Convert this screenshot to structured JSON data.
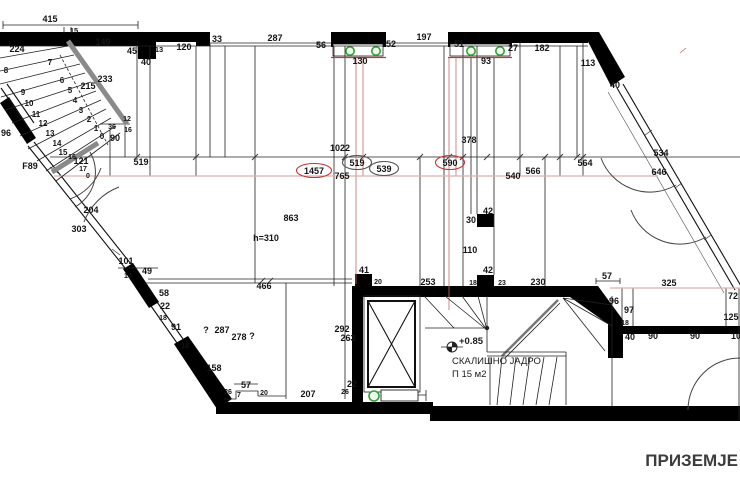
{
  "title": "ПРИЗЕМЈЕ",
  "stair_core": {
    "level": "+0.85",
    "name": "СКАЛИШНО ЈАДРО",
    "area": "П 15 м2"
  },
  "colors": {
    "wall": "#000000",
    "accent_red": "#cc3333",
    "pink_line": "#ddb0b0",
    "column_green": "#2fa32f",
    "rail_gray": "#8a8a8a",
    "title_gray": "#3c3c3c"
  },
  "icons": {
    "level_marker": "half-filled-circle-benchmark",
    "column": "green-circle",
    "elevator": "crossed-box"
  },
  "plan": {
    "labels": [
      {
        "t": "415",
        "x": 50,
        "y": 19
      },
      {
        "t": "15",
        "x": 74,
        "y": 30,
        "fs": 7.5
      },
      {
        "t": "224",
        "x": 17,
        "y": 49
      },
      {
        "t": "149",
        "x": 103,
        "y": 42
      },
      {
        "t": "45",
        "x": 132,
        "y": 51
      },
      {
        "t": "13",
        "x": 159,
        "y": 49,
        "fs": 7.5
      },
      {
        "t": "40",
        "x": 146,
        "y": 62
      },
      {
        "t": "120",
        "x": 184,
        "y": 47
      },
      {
        "t": "33",
        "x": 217,
        "y": 39
      },
      {
        "t": "287",
        "x": 275,
        "y": 38
      },
      {
        "t": "56",
        "x": 321,
        "y": 45
      },
      {
        "t": "130",
        "x": 360,
        "y": 61
      },
      {
        "t": "52",
        "x": 391,
        "y": 44
      },
      {
        "t": "197",
        "x": 424,
        "y": 37
      },
      {
        "t": "51",
        "x": 459,
        "y": 44
      },
      {
        "t": "93",
        "x": 486,
        "y": 61
      },
      {
        "t": "27",
        "x": 513,
        "y": 48
      },
      {
        "t": "182",
        "x": 542,
        "y": 48
      },
      {
        "t": "113",
        "x": 588,
        "y": 63
      },
      {
        "t": "40",
        "x": 615,
        "y": 85
      },
      {
        "t": "8",
        "x": 6,
        "y": 70,
        "fs": 8
      },
      {
        "t": "7",
        "x": 50,
        "y": 62,
        "fs": 8
      },
      {
        "t": "9",
        "x": 23,
        "y": 92,
        "fs": 8
      },
      {
        "t": "6",
        "x": 62,
        "y": 80,
        "fs": 8
      },
      {
        "t": "5",
        "x": 70,
        "y": 90,
        "fs": 8
      },
      {
        "t": "233",
        "x": 105,
        "y": 79
      },
      {
        "t": "215",
        "x": 88,
        "y": 86
      },
      {
        "t": "10",
        "x": 29,
        "y": 103,
        "fs": 8
      },
      {
        "t": "4",
        "x": 75,
        "y": 100,
        "fs": 8
      },
      {
        "t": "11",
        "x": 36,
        "y": 114,
        "fs": 8
      },
      {
        "t": "3",
        "x": 81,
        "y": 110,
        "fs": 8
      },
      {
        "t": "12",
        "x": 43,
        "y": 123,
        "fs": 8
      },
      {
        "t": "2",
        "x": 89,
        "y": 119,
        "fs": 8
      },
      {
        "t": "13",
        "x": 50,
        "y": 133,
        "fs": 8
      },
      {
        "t": "1",
        "x": 96,
        "y": 128,
        "fs": 8
      },
      {
        "t": "14",
        "x": 57,
        "y": 143,
        "fs": 8
      },
      {
        "t": "0",
        "x": 102,
        "y": 136,
        "fs": 8
      },
      {
        "t": "15",
        "x": 63,
        "y": 152,
        "fs": 8
      },
      {
        "t": "96",
        "x": 6,
        "y": 133
      },
      {
        "t": "36",
        "x": 112,
        "y": 126,
        "fs": 7
      },
      {
        "t": "12",
        "x": 127,
        "y": 118,
        "fs": 7
      },
      {
        "t": "16",
        "x": 128,
        "y": 129,
        "fs": 7
      },
      {
        "t": "90",
        "x": 115,
        "y": 138
      },
      {
        "t": "F89",
        "x": 30,
        "y": 166
      },
      {
        "t": "121",
        "x": 81,
        "y": 161
      },
      {
        "t": "16",
        "x": 72,
        "y": 156,
        "fs": 7,
        "c": "#9a9a9a"
      },
      {
        "t": "17",
        "x": 83,
        "y": 168,
        "fs": 7,
        "c": "#bb8877"
      },
      {
        "t": "0",
        "x": 88,
        "y": 175,
        "fs": 7,
        "c": "#cc5544"
      },
      {
        "t": "519",
        "x": 141,
        "y": 162
      },
      {
        "t": "204",
        "x": 91,
        "y": 210
      },
      {
        "t": "303",
        "x": 79,
        "y": 229
      },
      {
        "t": "101",
        "x": 126,
        "y": 261
      },
      {
        "t": "13",
        "x": 128,
        "y": 275,
        "fs": 7.5
      },
      {
        "t": "49",
        "x": 147,
        "y": 271
      },
      {
        "t": "58",
        "x": 164,
        "y": 293
      },
      {
        "t": "22",
        "x": 165,
        "y": 306
      },
      {
        "t": "18",
        "x": 163,
        "y": 317,
        "fs": 7
      },
      {
        "t": "91",
        "x": 176,
        "y": 327
      },
      {
        "t": "18",
        "x": 185,
        "y": 345,
        "fs": 7
      },
      {
        "t": "158",
        "x": 214,
        "y": 368
      },
      {
        "t": "1022",
        "x": 340,
        "y": 148
      },
      {
        "t": "519",
        "x": 357,
        "y": 163,
        "cls": "circ"
      },
      {
        "t": "1457",
        "x": 314,
        "y": 171,
        "cls": "circ-red"
      },
      {
        "t": "765",
        "x": 342,
        "y": 176
      },
      {
        "t": "539",
        "x": 384,
        "y": 169,
        "cls": "circ"
      },
      {
        "t": "590",
        "x": 450,
        "y": 163,
        "cls": "circ-red"
      },
      {
        "t": "378",
        "x": 469,
        "y": 140
      },
      {
        "t": "540",
        "x": 513,
        "y": 176
      },
      {
        "t": "566",
        "x": 533,
        "y": 171
      },
      {
        "t": "564",
        "x": 585,
        "y": 163
      },
      {
        "t": "534",
        "x": 661,
        "y": 153
      },
      {
        "t": "646",
        "x": 659,
        "y": 172
      },
      {
        "t": "863",
        "x": 291,
        "y": 218
      },
      {
        "t": "h=310",
        "x": 266,
        "y": 238
      },
      {
        "t": "42",
        "x": 488,
        "y": 211
      },
      {
        "t": "30",
        "x": 471,
        "y": 220
      },
      {
        "t": "110",
        "x": 470,
        "y": 250
      },
      {
        "t": "42",
        "x": 488,
        "y": 270
      },
      {
        "t": "41",
        "x": 364,
        "y": 270
      },
      {
        "t": "20",
        "x": 378,
        "y": 281,
        "fs": 7
      },
      {
        "t": "253",
        "x": 428,
        "y": 282
      },
      {
        "t": "18",
        "x": 473,
        "y": 282,
        "fs": 7
      },
      {
        "t": "23",
        "x": 502,
        "y": 282,
        "fs": 7
      },
      {
        "t": "230",
        "x": 538,
        "y": 282
      },
      {
        "t": "57",
        "x": 607,
        "y": 276
      },
      {
        "t": "325",
        "x": 669,
        "y": 283
      },
      {
        "t": "96",
        "x": 614,
        "y": 301
      },
      {
        "t": "97",
        "x": 629,
        "y": 310
      },
      {
        "t": "18",
        "x": 625,
        "y": 322,
        "fs": 7
      },
      {
        "t": "72",
        "x": 733,
        "y": 296
      },
      {
        "t": "125",
        "x": 731,
        "y": 317
      },
      {
        "t": "40",
        "x": 630,
        "y": 337
      },
      {
        "t": "90",
        "x": 653,
        "y": 336
      },
      {
        "t": "90",
        "x": 695,
        "y": 336
      },
      {
        "t": "10",
        "x": 736,
        "y": 336
      },
      {
        "t": "466",
        "x": 264,
        "y": 286
      },
      {
        "t": "?",
        "x": 206,
        "y": 330
      },
      {
        "t": "287",
        "x": 222,
        "y": 330
      },
      {
        "t": "278",
        "x": 239,
        "y": 337
      },
      {
        "t": "?",
        "x": 252,
        "y": 336
      },
      {
        "t": "292",
        "x": 342,
        "y": 329
      },
      {
        "t": "263",
        "x": 348,
        "y": 338
      },
      {
        "t": "57",
        "x": 246,
        "y": 385
      },
      {
        "t": "26",
        "x": 228,
        "y": 391,
        "fs": 7
      },
      {
        "t": "7",
        "x": 239,
        "y": 394,
        "fs": 7
      },
      {
        "t": "20",
        "x": 264,
        "y": 392,
        "fs": 7
      },
      {
        "t": "207",
        "x": 308,
        "y": 394
      },
      {
        "t": "26",
        "x": 345,
        "y": 391,
        "fs": 7
      },
      {
        "t": "22",
        "x": 352,
        "y": 384
      }
    ]
  }
}
